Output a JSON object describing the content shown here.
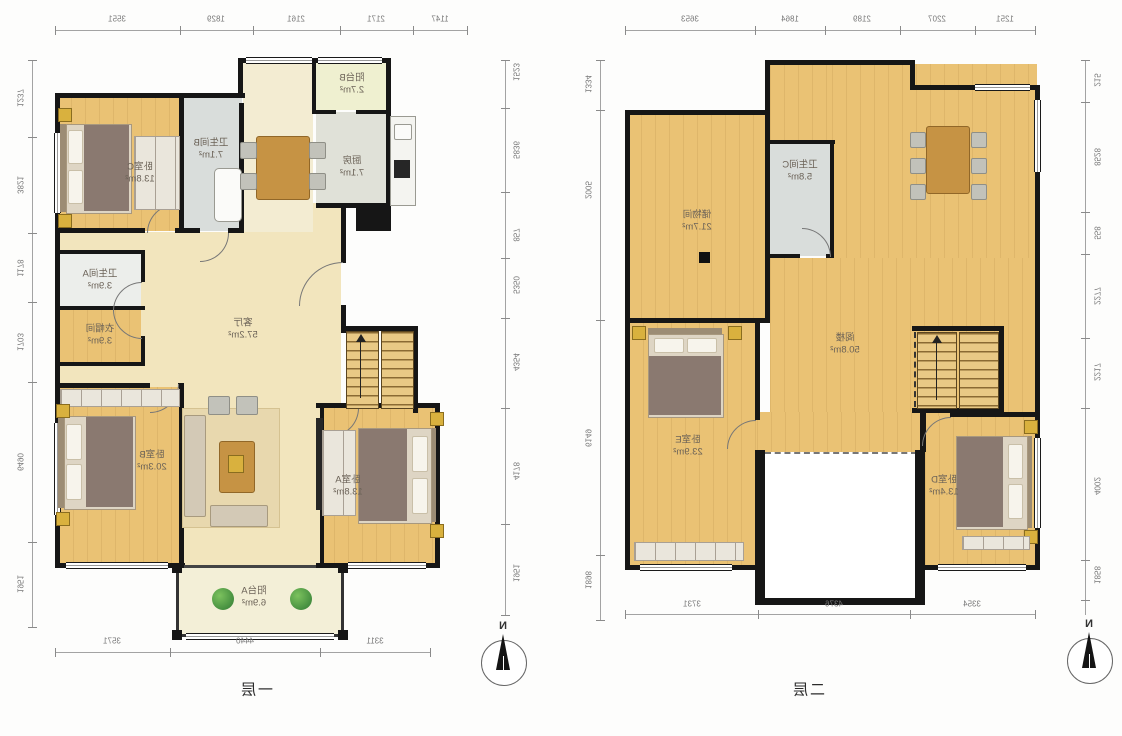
{
  "floor1": {
    "title": "一层",
    "compass_letter": "N",
    "rooms": {
      "balcony_b": {
        "name": "阳台B",
        "area": "2.7m²"
      },
      "kitchen": {
        "name": "厨房",
        "area": "7.1m²"
      },
      "bath_b": {
        "name": "卫生间B",
        "area": "7.1m²"
      },
      "bed_c": {
        "name": "卧室C",
        "area": "13.8m²"
      },
      "bath_a": {
        "name": "卫生间A",
        "area": "3.9m²"
      },
      "cloakroom": {
        "name": "衣帽间",
        "area": "3.9m²"
      },
      "living": {
        "name": "客厅",
        "area": "57.2m²"
      },
      "bed_b": {
        "name": "卧室B",
        "area": "20.3m²"
      },
      "bed_a": {
        "name": "卧室A",
        "area": "13.8m²"
      },
      "balcony_a": {
        "name": "阳台A",
        "area": "6.9m²"
      }
    },
    "dims": {
      "top": [
        "3551",
        "1829",
        "2161",
        "2171",
        "1147"
      ],
      "bottom": [
        "3571",
        "4440",
        "3311"
      ],
      "left": [
        "1237",
        "3821",
        "1178",
        "1703",
        "6490",
        "1951"
      ],
      "right": [
        "1523",
        "5836",
        "857",
        "5350",
        "4354",
        "4178",
        "1951"
      ]
    }
  },
  "floor2": {
    "title": "二层",
    "compass_letter": "N",
    "rooms": {
      "storage": {
        "name": "储物间",
        "area": "21.7m²"
      },
      "bath_c": {
        "name": "卫生间C",
        "area": "5.8m²"
      },
      "loft": {
        "name": "阁楼",
        "area": "50.8m²"
      },
      "bed_e": {
        "name": "卧室E",
        "area": "23.9m²"
      },
      "bed_d": {
        "name": "卧室D",
        "area": "13.4m²"
      }
    },
    "dims": {
      "top": [
        "3653",
        "1864",
        "2189",
        "2207",
        "1251"
      ],
      "bottom": [
        "3731",
        "4376",
        "3354"
      ],
      "left": [
        "1334",
        "2005",
        "6149",
        "1898"
      ],
      "right": [
        "215",
        "8528",
        "558",
        "2277",
        "2217",
        "4002",
        "1858"
      ]
    }
  },
  "colors": {
    "wall": "#161616",
    "wood_floor": "#eac274",
    "living_floor": "#f2e5bd",
    "bathroom_floor": "#d9dddb",
    "balcony_floor": "#eff0d0",
    "accent_gold": "#d9b13e",
    "dimension_text": "#787878"
  },
  "note": "mirrored-floor-plan-image"
}
